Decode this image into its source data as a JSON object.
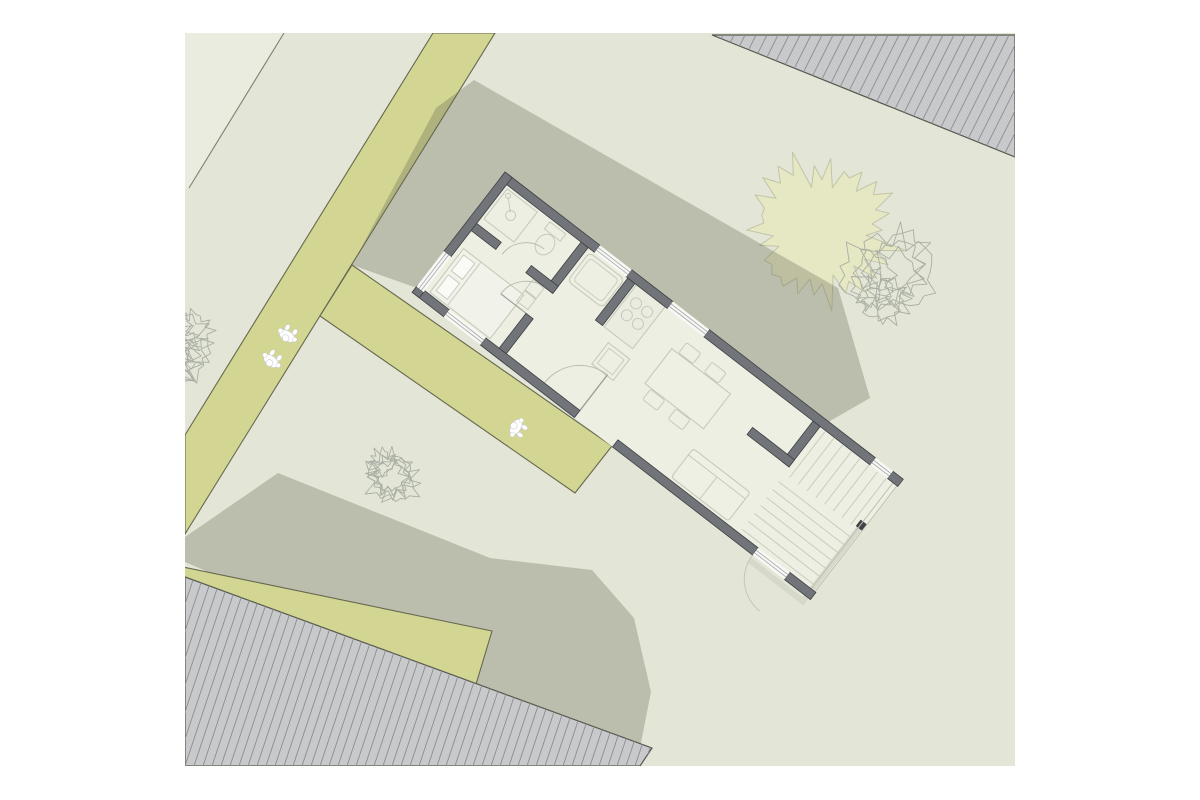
{
  "canvas": {
    "width": 1200,
    "height": 800,
    "background": "#ffffff"
  },
  "view": {
    "x": 185,
    "y": 33,
    "w": 830,
    "h": 733
  },
  "palette": {
    "ground": "#e3e6d6",
    "parcel_light": "#e9ecde",
    "boundary_line": "#7e816f",
    "path": "#d3d593",
    "path_edge": "#66684f",
    "shadow": "rgba(96,98,78,0.30)",
    "roof_fill": "#c8c9cb",
    "roof_hatch": "#8b8d93",
    "roof_edge": "#55574d",
    "wall": "#717478",
    "wall_edge": "#3e4044",
    "floor": "#edefe2",
    "furniture": "#c6cabb",
    "window": "#f7f8f3",
    "mullion": "#a6aaaf",
    "deck": "#c9ccbf",
    "tree_fill": "#e6e7c3",
    "tree_edge": "#c2c4a8",
    "tree_sketch": "#a9aea4",
    "person_fill": "#ffffff",
    "person_edge": "#c7cbd2"
  },
  "layers": [
    {
      "t": "poly",
      "n": "lawn-ground",
      "pts": [
        [
          185,
          33
        ],
        [
          1015,
          33
        ],
        [
          1015,
          766
        ],
        [
          185,
          766
        ]
      ],
      "f": "#e3e6d6"
    },
    {
      "t": "poly",
      "n": "parcel-corner",
      "pts": [
        [
          185,
          33
        ],
        [
          284,
          33
        ],
        [
          189,
          188
        ],
        [
          185,
          188
        ]
      ],
      "f": "#e9ecde"
    },
    {
      "t": "line",
      "n": "parcel-boundary-line",
      "x1": 284,
      "y1": 33,
      "x2": 189,
      "y2": 188,
      "s": "#7e816f",
      "sw": 1.1
    },
    {
      "t": "blob",
      "n": "tree-canopy-filled",
      "cx": 822,
      "cy": 230,
      "r": 74,
      "spikes": 26,
      "irr": 0.38,
      "seed": 7,
      "f": "#e6e7c3",
      "s": "#c2c4a8",
      "sw": 1
    },
    {
      "t": "cluster",
      "n": "tree-sketch-right",
      "cx": 893,
      "cy": 280,
      "r": 56,
      "blobs": 8,
      "seed": 3,
      "s": "#a9aea4",
      "sw": 0.9
    },
    {
      "t": "poly",
      "n": "path-main",
      "pts": [
        [
          433,
          33
        ],
        [
          495,
          33
        ],
        [
          185,
          534
        ],
        [
          185,
          435
        ]
      ],
      "f": "#d3d593",
      "s": "#66684f",
      "sw": 1.1
    },
    {
      "t": "poly",
      "n": "shadow-northeast",
      "pts": [
        [
          436,
          108
        ],
        [
          474,
          80
        ],
        [
          838,
          288
        ],
        [
          870,
          398
        ],
        [
          797,
          440
        ],
        [
          505,
          172
        ],
        [
          428,
          292
        ],
        [
          352,
          265
        ]
      ],
      "f": "rgba(96,98,78,0.30)"
    },
    {
      "t": "poly",
      "n": "shadow-southwest",
      "pts": [
        [
          278,
          473
        ],
        [
          490,
          558
        ],
        [
          592,
          570
        ],
        [
          634,
          618
        ],
        [
          651,
          692
        ],
        [
          638,
          758
        ],
        [
          609,
          766
        ],
        [
          400,
          655
        ],
        [
          185,
          562
        ],
        [
          185,
          537
        ]
      ],
      "f": "rgba(96,98,78,0.30)"
    },
    {
      "t": "poly",
      "n": "path-entrance",
      "pts": [
        [
          352,
          265
        ],
        [
          612,
          446
        ],
        [
          575,
          493
        ],
        [
          320,
          316
        ]
      ],
      "f": "#d3d593",
      "s": "#66684f",
      "sw": 1.1
    },
    {
      "t": "poly",
      "n": "path-bottom",
      "pts": [
        [
          183,
          567
        ],
        [
          492,
          631
        ],
        [
          474,
          691
        ],
        [
          183,
          628
        ]
      ],
      "f": "#d3d593",
      "s": "#66684f",
      "sw": 1.1
    },
    {
      "t": "cluster",
      "n": "tree-sketch-left",
      "cx": 183,
      "cy": 345,
      "r": 56,
      "blobs": 8,
      "seed": 11,
      "s": "#a9aea4",
      "sw": 0.9
    },
    {
      "t": "cluster",
      "n": "tree-sketch-middle",
      "cx": 388,
      "cy": 477,
      "r": 34,
      "blobs": 6,
      "seed": 5,
      "s": "#a9aea4",
      "sw": 0.9
    },
    {
      "t": "hatchpoly",
      "n": "neighbor-roof-southwest",
      "pts": [
        [
          185,
          577
        ],
        [
          652,
          748
        ],
        [
          640,
          766
        ],
        [
          185,
          766
        ]
      ],
      "f": "#c8c9cb",
      "s": "#55574d",
      "sw": 1.2,
      "slope": -3.0,
      "spacing": 9,
      "hs": "#8b8d93",
      "hw": 0.9
    },
    {
      "t": "hatchpoly",
      "n": "neighbor-roof-northeast",
      "pts": [
        [
          712,
          35
        ],
        [
          1015,
          157
        ],
        [
          1015,
          35
        ]
      ],
      "f": "#c8c9cb",
      "s": "#55574d",
      "sw": 1.2,
      "slope": -2.0,
      "spacing": 11,
      "hs": "#8b8d93",
      "hw": 0.9
    },
    {
      "t": "plan",
      "n": "house-floor-plan",
      "origin": [
        505,
        172
      ],
      "angle": 37.65,
      "items": [
        {
          "k": "rect",
          "n": "floor",
          "x": 0,
          "y": 0,
          "w": 503,
          "h": 152,
          "f": "#edefe2"
        },
        {
          "k": "path",
          "n": "garden-walkway",
          "d": "M430,158 L498,158 L498,62",
          "f": "none",
          "s": "#d4d7c8",
          "sw": 6,
          "o": 0.9
        },
        {
          "k": "rect",
          "n": "gate-post",
          "x": 494,
          "y": 58,
          "w": 8,
          "h": 8,
          "f": "#3f4146"
        },
        {
          "k": "line",
          "n": "terrace-edge",
          "x1": 497,
          "y1": 4,
          "x2": 497,
          "y2": 150,
          "s": "#bcc0b3",
          "sw": 1
        },
        {
          "k": "line",
          "n": "terrace-edge",
          "x1": 502,
          "y1": 4,
          "x2": 502,
          "y2": 150,
          "s": "#bcc0b3",
          "sw": 1
        },
        {
          "k": "lines",
          "n": "terrace-boards",
          "dir": "h",
          "from": 78,
          "to": 138,
          "step": 10,
          "a": 406,
          "b": 496,
          "s": "#c9ccbf",
          "sw": 1
        },
        {
          "k": "lines",
          "n": "stair-treads",
          "dir": "v",
          "from": 412,
          "to": 489,
          "step": 11,
          "a": 10,
          "b": 68,
          "s": "#c9ccbf",
          "sw": 1
        },
        {
          "k": "rect",
          "n": "bed",
          "x": 14,
          "y": 86,
          "w": 76,
          "h": 55,
          "f": "#f1f2e9",
          "s": "#c6cabb",
          "sw": 1.1
        },
        {
          "k": "line",
          "n": "bed-line",
          "x1": 36,
          "y1": 86,
          "x2": 36,
          "y2": 141,
          "s": "#c6cabb",
          "sw": 1
        },
        {
          "k": "rect",
          "n": "pillow",
          "x": 18,
          "y": 91,
          "w": 14,
          "h": 20,
          "f": "#fafbf6",
          "s": "#c6cabb",
          "sw": 0.9
        },
        {
          "k": "rect",
          "n": "pillow",
          "x": 18,
          "y": 116,
          "w": 14,
          "h": 20,
          "f": "#fafbf6",
          "s": "#c6cabb",
          "sw": 0.9
        },
        {
          "k": "rect",
          "n": "closet",
          "x": 88,
          "y": 68,
          "w": 14,
          "h": 13,
          "f": "none",
          "s": "#c6cabb",
          "sw": 1
        },
        {
          "k": "rect",
          "n": "closet",
          "x": 88,
          "y": 82,
          "w": 14,
          "h": 13,
          "f": "none",
          "s": "#c6cabb",
          "sw": 1
        },
        {
          "k": "rect",
          "n": "shower",
          "x": 12,
          "y": 12,
          "w": 38,
          "h": 38,
          "f": "none",
          "s": "#c6cabb",
          "sw": 1.1
        },
        {
          "k": "circle",
          "n": "shower-drain",
          "cx": 31,
          "cy": 31,
          "r": 5,
          "f": "none",
          "s": "#c6cabb",
          "sw": 1
        },
        {
          "k": "circle",
          "n": "shower-head",
          "cx": 17,
          "cy": 17,
          "r": 2.5,
          "f": "none",
          "s": "#c6cabb",
          "sw": 1
        },
        {
          "k": "line",
          "n": "shower-hose",
          "x1": 18,
          "y1": 18,
          "x2": 29,
          "y2": 29,
          "s": "#c6cabb",
          "sw": 1
        },
        {
          "k": "rect",
          "n": "toilet-tank",
          "x": 66,
          "y": 12,
          "w": 20,
          "h": 9,
          "f": "none",
          "s": "#c6cabb",
          "sw": 1
        },
        {
          "k": "ellipse",
          "n": "toilet-bowl",
          "cx": 76,
          "cy": 33,
          "rx": 9,
          "ry": 11,
          "f": "none",
          "s": "#c6cabb",
          "sw": 1
        },
        {
          "k": "rect",
          "n": "bathtub",
          "x": 116,
          "y": 12,
          "w": 44,
          "h": 36,
          "rx": 5,
          "f": "none",
          "s": "#c6cabb",
          "sw": 1.1
        },
        {
          "k": "rect",
          "n": "bathtub-inner",
          "x": 120,
          "y": 16,
          "w": 36,
          "h": 28,
          "rx": 4,
          "f": "none",
          "s": "#c6cabb",
          "sw": 0.9
        },
        {
          "k": "rect",
          "n": "kitchen-counter",
          "x": 173,
          "y": 9,
          "w": 36,
          "h": 53,
          "f": "#eaece0",
          "s": "#c6cabb",
          "sw": 1.1
        },
        {
          "k": "circle",
          "n": "stove-burner",
          "cx": 184,
          "cy": 24,
          "r": 5.5,
          "f": "none",
          "s": "#c6cabb",
          "sw": 1
        },
        {
          "k": "circle",
          "n": "stove-burner",
          "cx": 198,
          "cy": 24,
          "r": 5.5,
          "f": "none",
          "s": "#c6cabb",
          "sw": 1
        },
        {
          "k": "circle",
          "n": "stove-burner",
          "cx": 184,
          "cy": 39,
          "r": 5.5,
          "f": "none",
          "s": "#c6cabb",
          "sw": 1
        },
        {
          "k": "circle",
          "n": "stove-burner",
          "cx": 198,
          "cy": 39,
          "r": 5.5,
          "f": "none",
          "s": "#c6cabb",
          "sw": 1
        },
        {
          "k": "rect",
          "n": "kitchen-island",
          "x": 186,
          "y": 72,
          "w": 27,
          "h": 27,
          "f": "none",
          "s": "#c6cabb",
          "sw": 1.1
        },
        {
          "k": "rect",
          "n": "kitchen-sink",
          "x": 190,
          "y": 76,
          "w": 19,
          "h": 19,
          "f": "none",
          "s": "#c6cabb",
          "sw": 0.9
        },
        {
          "k": "rect",
          "n": "dining-table",
          "x": 240,
          "y": 38,
          "w": 74,
          "h": 44,
          "f": "#eef0e4",
          "s": "#c6cabb",
          "sw": 1.1
        },
        {
          "k": "rect",
          "n": "chair",
          "x": 248,
          "y": 24,
          "w": 18,
          "h": 13,
          "rx": 2,
          "f": "none",
          "s": "#c6cabb",
          "sw": 1
        },
        {
          "k": "rect",
          "n": "chair",
          "x": 280,
          "y": 24,
          "w": 18,
          "h": 13,
          "rx": 2,
          "f": "none",
          "s": "#c6cabb",
          "sw": 1
        },
        {
          "k": "rect",
          "n": "chair",
          "x": 248,
          "y": 83,
          "w": 18,
          "h": 13,
          "rx": 2,
          "f": "none",
          "s": "#c6cabb",
          "sw": 1
        },
        {
          "k": "rect",
          "n": "chair",
          "x": 280,
          "y": 83,
          "w": 18,
          "h": 13,
          "rx": 2,
          "f": "none",
          "s": "#c6cabb",
          "sw": 1
        },
        {
          "k": "rect",
          "n": "sofa",
          "x": 318,
          "y": 104,
          "w": 72,
          "h": 36,
          "rx": 3,
          "f": "#eef0e4",
          "s": "#c6cabb",
          "sw": 1.1
        },
        {
          "k": "line",
          "n": "sofa-back",
          "x1": 318,
          "y1": 112,
          "x2": 390,
          "y2": 112,
          "s": "#c6cabb",
          "sw": 1
        },
        {
          "k": "line",
          "n": "sofa-split",
          "x1": 354,
          "y1": 112,
          "x2": 354,
          "y2": 140,
          "s": "#c6cabb",
          "sw": 1
        },
        {
          "k": "path",
          "n": "door-arc-entrance",
          "d": "M160,143 A45,45 0 0 1 205,98",
          "f": "none",
          "s": "#b9bdb0",
          "sw": 1
        },
        {
          "k": "line",
          "n": "door-leaf-entrance",
          "x1": 205,
          "y1": 143,
          "x2": 205,
          "y2": 98,
          "s": "#9ea29a",
          "sw": 1.4
        },
        {
          "k": "path",
          "n": "door-arc-terrace",
          "d": "M430,152 A40,40 0 0 0 470,192",
          "f": "none",
          "s": "#c3c7ba",
          "sw": 1
        },
        {
          "k": "path",
          "n": "door-arc-bedroom",
          "d": "M71,99 A32,32 0 0 1 103,67",
          "f": "none",
          "s": "#b9bdb0",
          "sw": 1
        },
        {
          "k": "line",
          "n": "door-leaf-bedroom",
          "x1": 103,
          "y1": 99,
          "x2": 71,
          "y2": 99,
          "s": "#9ea29a",
          "sw": 1.2
        },
        {
          "k": "path",
          "n": "door-arc-bath",
          "d": "M48,67 A30,30 0 0 1 78,37",
          "f": "none",
          "s": "#b9bdb0",
          "sw": 1
        },
        {
          "k": "rect",
          "n": "wall-north",
          "x": 0,
          "y": 0,
          "w": 120,
          "h": 9,
          "f": "#717478",
          "s": "#3e4044",
          "sw": 0.8
        },
        {
          "k": "rect",
          "n": "wall-north",
          "x": 160,
          "y": 0,
          "w": 52,
          "h": 9,
          "f": "#717478",
          "s": "#3e4044",
          "sw": 0.8
        },
        {
          "k": "rect",
          "n": "wall-north",
          "x": 258,
          "y": 0,
          "w": 210,
          "h": 9,
          "f": "#717478",
          "s": "#3e4044",
          "sw": 0.8
        },
        {
          "k": "rect",
          "n": "wall-north",
          "x": 490,
          "y": 0,
          "w": 13,
          "h": 9,
          "f": "#717478",
          "s": "#3e4044",
          "sw": 0.8
        },
        {
          "k": "rect",
          "n": "wall-south",
          "x": 0,
          "y": 143,
          "w": 40,
          "h": 9,
          "f": "#717478",
          "s": "#3e4044",
          "sw": 0.8
        },
        {
          "k": "rect",
          "n": "wall-south",
          "x": 86,
          "y": 143,
          "w": 119,
          "h": 9,
          "f": "#717478",
          "s": "#3e4044",
          "sw": 0.8
        },
        {
          "k": "rect",
          "n": "wall-south",
          "x": 253,
          "y": 143,
          "w": 177,
          "h": 9,
          "f": "#717478",
          "s": "#3e4044",
          "sw": 0.8
        },
        {
          "k": "rect",
          "n": "wall-south",
          "x": 470,
          "y": 143,
          "w": 33,
          "h": 9,
          "f": "#717478",
          "s": "#3e4044",
          "sw": 0.8
        },
        {
          "k": "rect",
          "n": "wall-west",
          "x": 0,
          "y": 0,
          "w": 9,
          "h": 100,
          "f": "#717478",
          "s": "#3e4044",
          "sw": 0.8
        },
        {
          "k": "rect",
          "n": "wall-west",
          "x": 0,
          "y": 145,
          "w": 9,
          "h": 7,
          "f": "#717478",
          "s": "#3e4044",
          "sw": 0.8
        },
        {
          "k": "rect",
          "n": "wall-bath-hall",
          "x": 103,
          "y": 9,
          "w": 9,
          "h": 58,
          "f": "#717478",
          "s": "#3e4044",
          "sw": 0.8
        },
        {
          "k": "rect",
          "n": "wall-bedroom-hall",
          "x": 103,
          "y": 99,
          "w": 9,
          "h": 44,
          "f": "#717478",
          "s": "#3e4044",
          "sw": 0.8
        },
        {
          "k": "rect",
          "n": "wall-wc-bedroom",
          "x": 9,
          "y": 58,
          "w": 31,
          "h": 9,
          "f": "#717478",
          "s": "#3e4044",
          "sw": 0.8
        },
        {
          "k": "rect",
          "n": "wall-wc-bedroom",
          "x": 78,
          "y": 58,
          "w": 34,
          "h": 9,
          "f": "#717478",
          "s": "#3e4044",
          "sw": 0.8
        },
        {
          "k": "rect",
          "n": "wall-kitchen",
          "x": 162,
          "y": 9,
          "w": 9,
          "h": 53,
          "f": "#717478",
          "s": "#3e4044",
          "sw": 0.8
        },
        {
          "k": "rect",
          "n": "wall-stairs",
          "x": 396,
          "y": 9,
          "w": 9,
          "h": 51,
          "f": "#717478",
          "s": "#3e4044",
          "sw": 0.8
        },
        {
          "k": "rect",
          "n": "wall-stairs-cap",
          "x": 352,
          "y": 51,
          "w": 53,
          "h": 9,
          "f": "#717478",
          "s": "#3e4044",
          "sw": 0.8
        },
        {
          "k": "window",
          "n": "window-north-1",
          "x": 120,
          "y": 0,
          "w": 40,
          "h": 9,
          "dir": "h"
        },
        {
          "k": "window",
          "n": "window-north-2",
          "x": 212,
          "y": 0,
          "w": 46,
          "h": 9,
          "dir": "h"
        },
        {
          "k": "window",
          "n": "window-north-3",
          "x": 468,
          "y": 0,
          "w": 22,
          "h": 9,
          "dir": "h"
        },
        {
          "k": "window",
          "n": "window-south-bedroom",
          "x": 40,
          "y": 143,
          "w": 46,
          "h": 9,
          "dir": "h"
        },
        {
          "k": "window",
          "n": "window-terrace-door",
          "x": 430,
          "y": 143,
          "w": 40,
          "h": 9,
          "dir": "h"
        },
        {
          "k": "window",
          "n": "window-west",
          "x": 0,
          "y": 100,
          "w": 9,
          "h": 45,
          "dir": "v"
        }
      ]
    },
    {
      "t": "person",
      "n": "person-walking",
      "x": 287,
      "y": 336,
      "a": 122
    },
    {
      "t": "person",
      "n": "person-walking",
      "x": 271,
      "y": 361,
      "a": 128
    },
    {
      "t": "person",
      "n": "person-walking",
      "x": 516,
      "y": 427,
      "a": 212
    }
  ]
}
